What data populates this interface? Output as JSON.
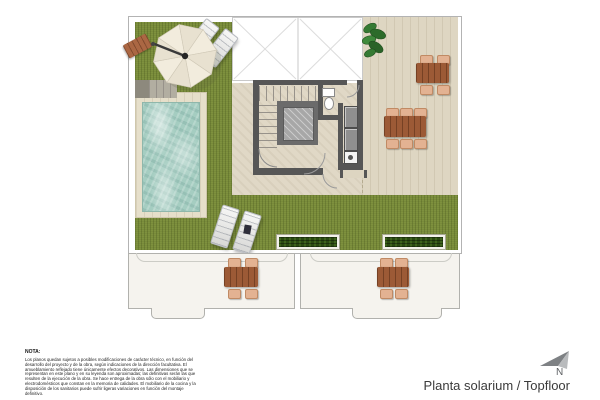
{
  "document": {
    "type": "architectural-floor-plan",
    "title": "Planta solarium / Topfloor"
  },
  "note": {
    "heading": "NOTA:",
    "body": "Los planos quedan sujetos a posibles modificaciones de carácter técnico, en función del desarrollo del proyecto y de la obra, según indicaciones de la dirección facultativa. El amueblamiento reflejado tiene únicamente efectos decorativos. Las dimensiones que se representan en este plano y en su leyenda son aproximadas; las definitivas serán las que resulten de la ejecución de la obra. Se hace entrega de la obra sólo con el mobiliario y electrodomésticos que constan en la memoria de calidades. El mobiliario de la cocina y la disposición de los sanitarios puede sufrir ligeras variaciones en función del montaje definitivo."
  },
  "footer": {
    "plan_label": "Planta solarium / Topfloor"
  },
  "compass": {
    "label": "N"
  },
  "icons": {
    "north-arrow-icon": "stylized gray arrowhead pointing upper-left",
    "parasol-icon": "octagonal cantilever parasol, cream",
    "plant-icon": "green corner plant",
    "toilet-icon": "wc bowl with cistern"
  },
  "palette": {
    "grass": "#7e913e",
    "terrace_deck": "#ded6c2",
    "mid_terrace": "#e0d8c6",
    "pool_water": "#a5cdc1",
    "pool_surround": "#e6dfca",
    "walls": "#565656",
    "wood_table": "#9c5a36",
    "chair": "#e3b292",
    "planter_green": "#2b4912",
    "lower_terrace": "#f5f3ee",
    "compass_gray": "#7e8184"
  }
}
